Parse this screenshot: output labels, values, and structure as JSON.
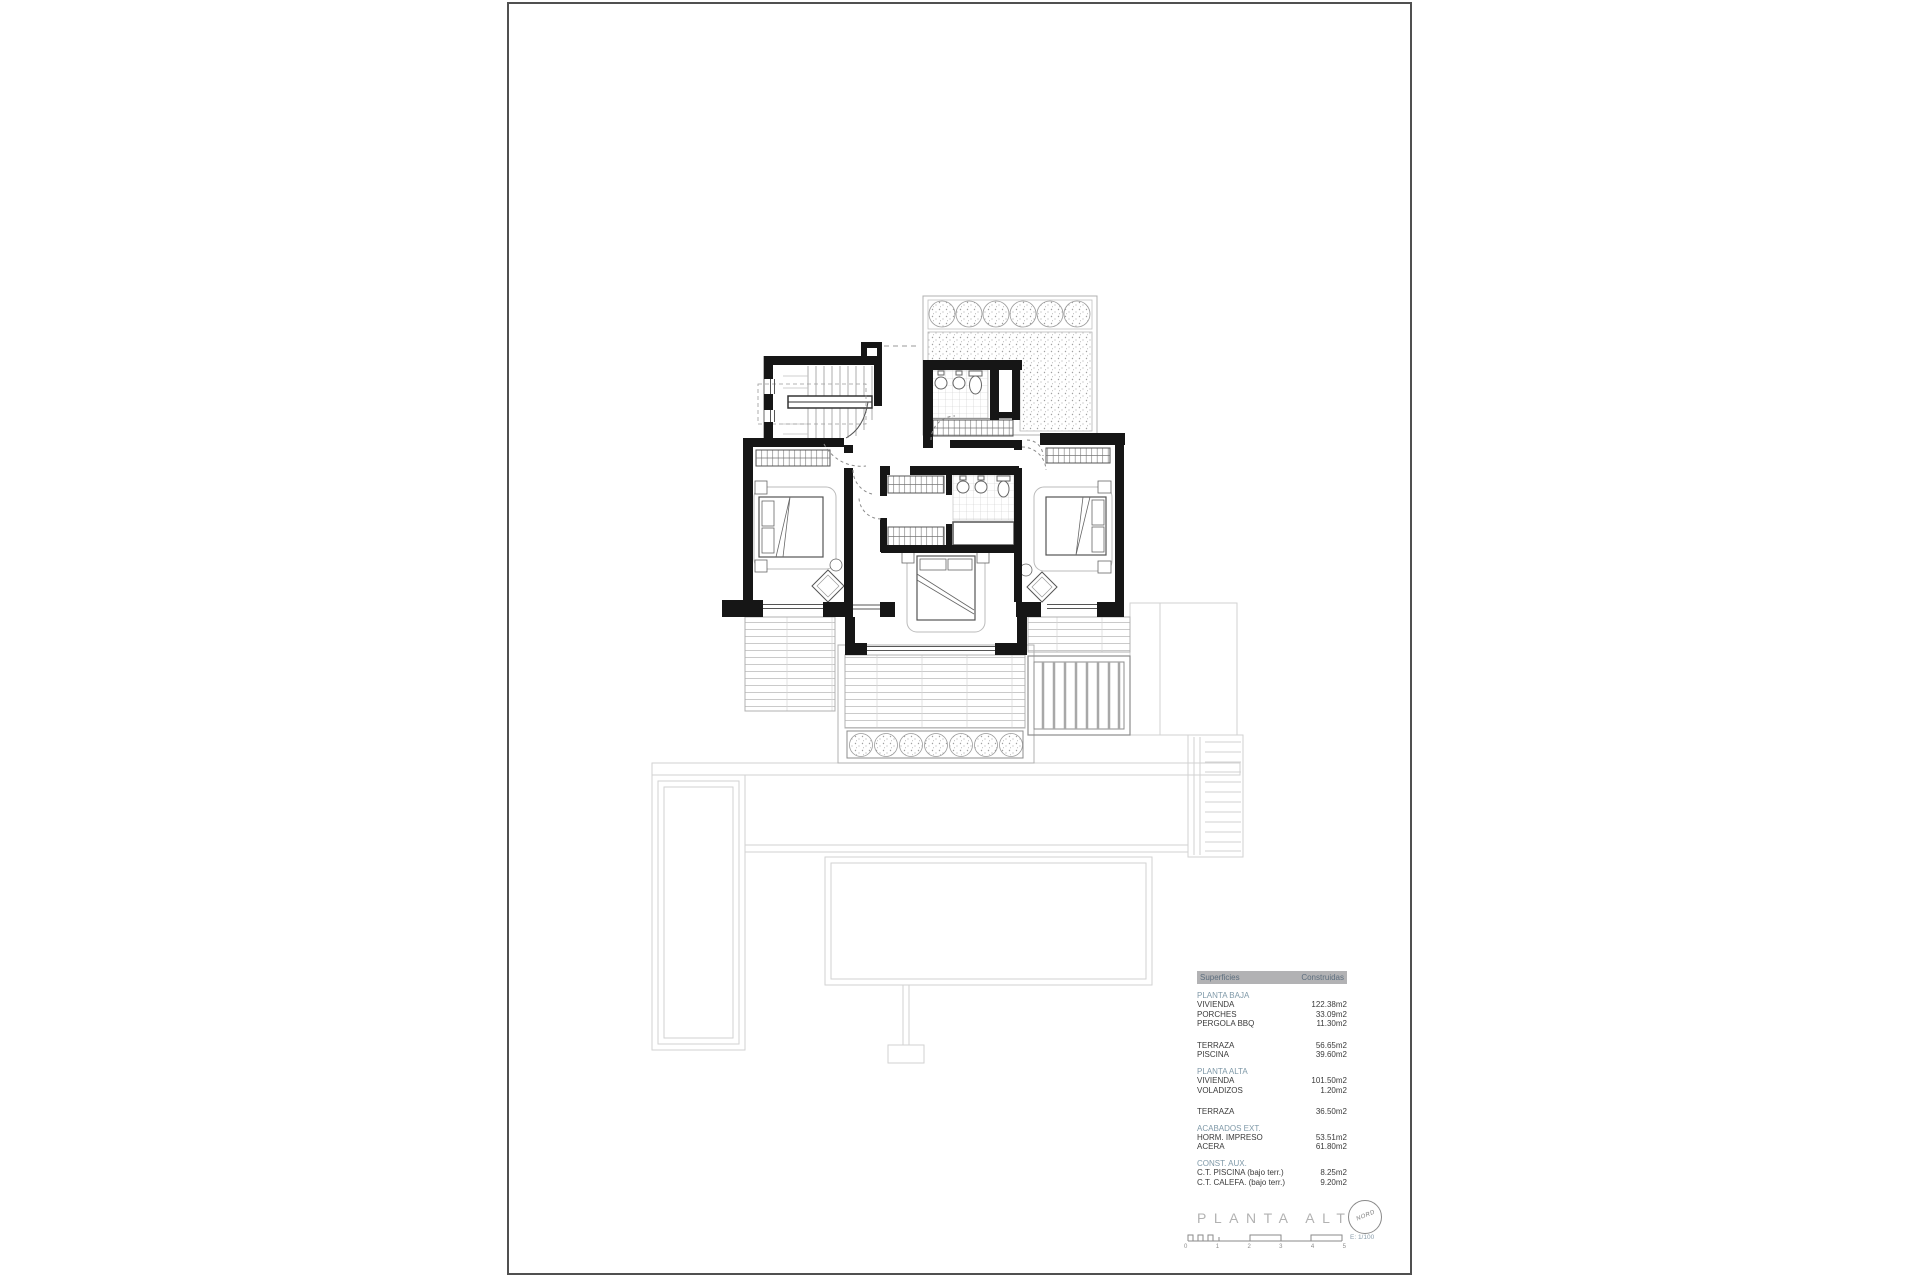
{
  "document": {
    "title": "PLANTA ALTA",
    "scale_label": "E: 1/100",
    "north_label": "NORD",
    "scale_ticks": [
      "0",
      "1",
      "2",
      "3",
      "4",
      "5"
    ]
  },
  "areas_table": {
    "header": {
      "col1": "Superficies",
      "col2": "Construidas"
    },
    "groups": [
      {
        "name": "PLANTA BAJA",
        "rows": [
          [
            "VIVIENDA",
            "122.38m2"
          ],
          [
            "PORCHES",
            "33.09m2"
          ],
          [
            "PERGOLA BBQ",
            "11.30m2"
          ]
        ]
      },
      {
        "name": "",
        "rows": [
          [
            "TERRAZA",
            "56.65m2"
          ],
          [
            "PISCINA",
            "39.60m2"
          ]
        ]
      },
      {
        "name": "PLANTA ALTA",
        "rows": [
          [
            "VIVIENDA",
            "101.50m2"
          ],
          [
            "VOLADIZOS",
            "1.20m2"
          ]
        ]
      },
      {
        "name": "",
        "rows": [
          [
            "TERRAZA",
            "36.50m2"
          ]
        ]
      },
      {
        "name": "ACABADOS EXT.",
        "rows": [
          [
            "HORM. IMPRESO",
            "53.51m2"
          ],
          [
            "ACERA",
            "61.80m2"
          ]
        ]
      },
      {
        "name": "CONST. AUX.",
        "rows": [
          [
            "C.T. PISCINA (bajo terr.)",
            "8.25m2"
          ],
          [
            "C.T. CALEFA. (bajo terr.)",
            "9.20m2"
          ]
        ]
      }
    ]
  },
  "colors": {
    "accent": "#7f99a8",
    "header_bg": "#b2b2b4",
    "title_gray": "#b2b2b2",
    "row_text": "#3b3b3b",
    "wall": "#161616"
  }
}
